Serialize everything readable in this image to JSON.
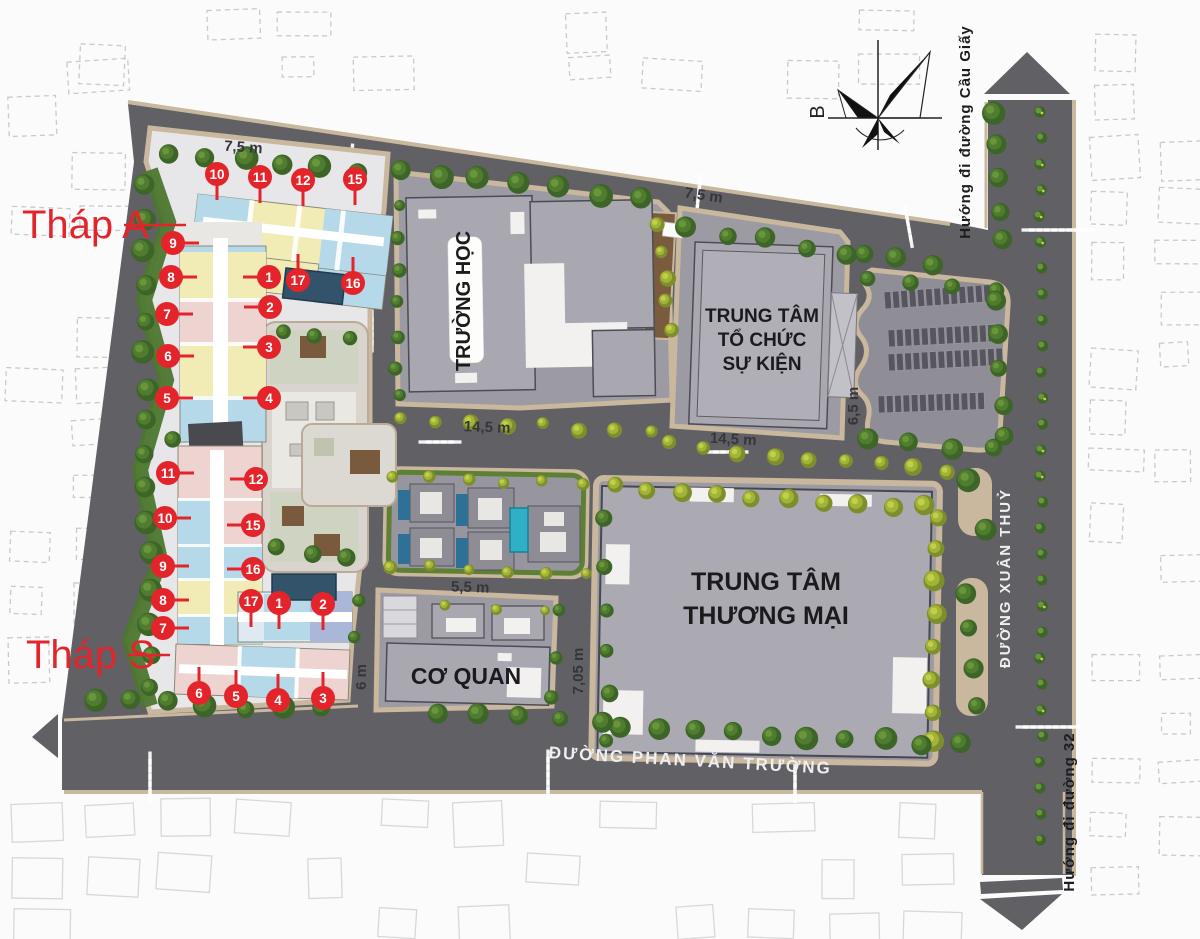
{
  "legend": {
    "tower_a_label": "Tháp A",
    "tower_s_label": "Tháp S"
  },
  "buildings": {
    "school": "TRƯỜNG HỌC",
    "event_center": {
      "line1": "TRUNG TÂM",
      "line2": "TỔ CHỨC",
      "line3": "SỰ KIỆN"
    },
    "mall": {
      "line1": "TRUNG TÂM",
      "line2": "THƯƠNG MẠI"
    },
    "office": "CƠ QUAN"
  },
  "streets": {
    "south": "ĐƯỜNG PHAN VĂN TRƯỜNG",
    "east": "ĐƯỜNG XUÂN THUỶ",
    "north_direction": "Hướng đi đường Cầu Giấy",
    "south_direction": "Hướng đi đường 32"
  },
  "compass": {
    "north_label": "B"
  },
  "dimensions": {
    "d1": "7,5 m",
    "d2": "7,5 m",
    "d3": "14,5 m",
    "d4": "14,5 m",
    "d5": "6,5 m",
    "d6": "5,5 m",
    "d7": "6 m",
    "d8": "7,05 m"
  },
  "colors": {
    "marker_red": "#e3242b",
    "asphalt": "#606065",
    "sidewalk": "#c9b79e",
    "building_gray": "#a9a8b0",
    "unit_blue": "#b5d9e9",
    "unit_yellow": "#f1ecb6",
    "unit_pink": "#eed4d0",
    "unit_periwinkle": "#aab7d9",
    "pool_dark": "#33536b",
    "pool_turquoise": "#2fb0c6",
    "tree_green": "#507c30",
    "bush_yellow_green": "#b9c63f"
  },
  "markers": {
    "tower_a": [
      {
        "n": "10",
        "x": 217,
        "y": 174,
        "dir": "down"
      },
      {
        "n": "11",
        "x": 260,
        "y": 177,
        "dir": "down"
      },
      {
        "n": "12",
        "x": 303,
        "y": 180,
        "dir": "down"
      },
      {
        "n": "15",
        "x": 355,
        "y": 179,
        "dir": "down"
      },
      {
        "n": "9",
        "x": 173,
        "y": 243,
        "dir": "right"
      },
      {
        "n": "8",
        "x": 171,
        "y": 277,
        "dir": "right"
      },
      {
        "n": "7",
        "x": 167,
        "y": 314,
        "dir": "right"
      },
      {
        "n": "6",
        "x": 168,
        "y": 356,
        "dir": "right"
      },
      {
        "n": "5",
        "x": 167,
        "y": 398,
        "dir": "right"
      },
      {
        "n": "1",
        "x": 269,
        "y": 277,
        "dir": "left"
      },
      {
        "n": "2",
        "x": 270,
        "y": 307,
        "dir": "left"
      },
      {
        "n": "3",
        "x": 269,
        "y": 347,
        "dir": "left"
      },
      {
        "n": "4",
        "x": 269,
        "y": 398,
        "dir": "left"
      },
      {
        "n": "17",
        "x": 298,
        "y": 280,
        "dir": "up"
      },
      {
        "n": "16",
        "x": 353,
        "y": 283,
        "dir": "up"
      }
    ],
    "tower_s": [
      {
        "n": "11",
        "x": 168,
        "y": 473,
        "dir": "right"
      },
      {
        "n": "12",
        "x": 256,
        "y": 479,
        "dir": "left"
      },
      {
        "n": "10",
        "x": 165,
        "y": 518,
        "dir": "right"
      },
      {
        "n": "15",
        "x": 253,
        "y": 525,
        "dir": "left"
      },
      {
        "n": "9",
        "x": 163,
        "y": 566,
        "dir": "right"
      },
      {
        "n": "16",
        "x": 253,
        "y": 569,
        "dir": "left"
      },
      {
        "n": "8",
        "x": 163,
        "y": 600,
        "dir": "right"
      },
      {
        "n": "7",
        "x": 163,
        "y": 628,
        "dir": "right"
      },
      {
        "n": "17",
        "x": 251,
        "y": 601,
        "dir": "down"
      },
      {
        "n": "1",
        "x": 279,
        "y": 603,
        "dir": "down"
      },
      {
        "n": "2",
        "x": 323,
        "y": 604,
        "dir": "down"
      },
      {
        "n": "6",
        "x": 199,
        "y": 693,
        "dir": "up"
      },
      {
        "n": "5",
        "x": 236,
        "y": 696,
        "dir": "up"
      },
      {
        "n": "4",
        "x": 278,
        "y": 700,
        "dir": "up"
      },
      {
        "n": "3",
        "x": 323,
        "y": 698,
        "dir": "up"
      }
    ]
  }
}
